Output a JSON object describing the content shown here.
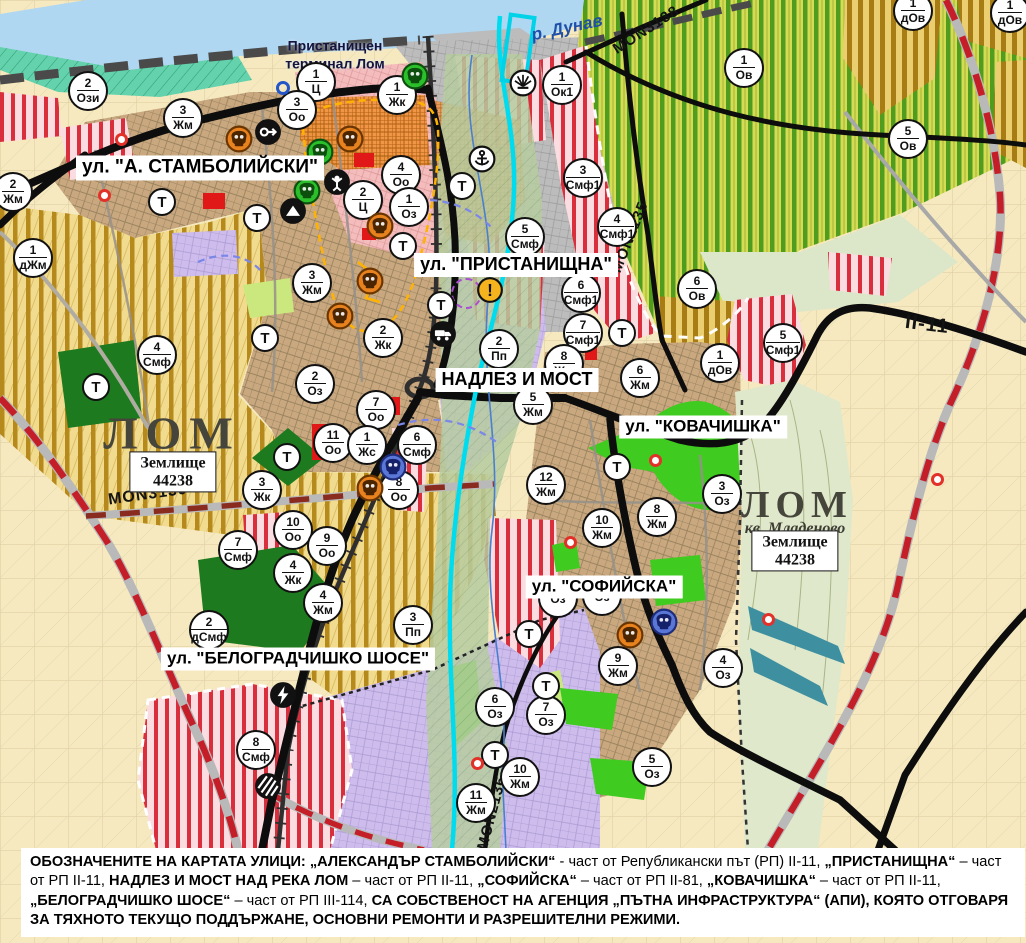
{
  "map": {
    "hydro_label": "р. Дунав",
    "port_label_line1": "Пристанищен",
    "port_label_line2": "терминал Лом",
    "t_label": "Т",
    "street_labels": [
      [
        "ул. \"А. СТАМБОЛИЙСКИ\"",
        200,
        168,
        19
      ],
      [
        "ул. \"ПРИСТАНИЩНА\"",
        516,
        265,
        18
      ],
      [
        "НАДЛЕЗ И МОСТ",
        517,
        380,
        18
      ],
      [
        "ул. \"КОВАЧИШКА\"",
        703,
        427,
        17
      ],
      [
        "ул. \"СОФИЙСКА\"",
        604,
        587,
        17
      ],
      [
        "ул. \"БЕЛОГРАДЧИШКО ШОСЕ\"",
        298,
        659,
        17
      ]
    ],
    "city_labels": [
      {
        "text": "ЛОМ",
        "x": 172,
        "y": 433,
        "cls": "city"
      },
      {
        "text": "ЛОМ",
        "x": 797,
        "y": 505,
        "cls": "city2"
      },
      {
        "text": "кв. Младеново",
        "x": 795,
        "y": 529,
        "cls": "sub"
      }
    ],
    "land_boxes": [
      {
        "line1": "Землище",
        "line2": "44238",
        "x": 173,
        "y": 472
      },
      {
        "line1": "Землище",
        "line2": "44238",
        "x": 795,
        "y": 551
      }
    ],
    "road_labels": [
      [
        "MON3139",
        148,
        495,
        -8,
        16
      ],
      [
        "MON2135",
        630,
        237,
        -68,
        15
      ],
      [
        "MON3138",
        646,
        30,
        -33,
        15
      ],
      [
        "MON2136",
        492,
        813,
        -75,
        15
      ],
      [
        "II-11",
        927,
        325,
        7,
        20
      ]
    ],
    "markers": [
      [
        88,
        91,
        "2",
        "Ози"
      ],
      [
        316,
        82,
        "1",
        "Ц"
      ],
      [
        297,
        110,
        "3",
        "Оо"
      ],
      [
        397,
        95,
        "1",
        "Жк"
      ],
      [
        562,
        85,
        "1",
        "Ок1"
      ],
      [
        183,
        118,
        "3",
        "Жм"
      ],
      [
        13,
        192,
        "2",
        "Жм"
      ],
      [
        33,
        258,
        "1",
        "дЖм"
      ],
      [
        157,
        355,
        "4",
        "Смф"
      ],
      [
        401,
        175,
        "4",
        "Оо"
      ],
      [
        363,
        200,
        "2",
        "Ц"
      ],
      [
        409,
        207,
        "1",
        "Оз"
      ],
      [
        312,
        283,
        "3",
        "Жм"
      ],
      [
        383,
        338,
        "2",
        "Жк"
      ],
      [
        315,
        384,
        "2",
        "Оз"
      ],
      [
        525,
        237,
        "5",
        "Смф"
      ],
      [
        583,
        178,
        "3",
        "Смф1"
      ],
      [
        617,
        227,
        "4",
        "Смф1"
      ],
      [
        744,
        68,
        "1",
        "Ов"
      ],
      [
        908,
        139,
        "5",
        "Ов"
      ],
      [
        913,
        11,
        "1",
        "дОв"
      ],
      [
        1010,
        13,
        "1",
        "дОв"
      ],
      [
        697,
        289,
        "6",
        "Ов"
      ],
      [
        720,
        363,
        "1",
        "дОв"
      ],
      [
        783,
        343,
        "5",
        "Смф1"
      ],
      [
        581,
        293,
        "6",
        "Смф1"
      ],
      [
        583,
        333,
        "7",
        "Смф1"
      ],
      [
        564,
        364,
        "8",
        "Жм"
      ],
      [
        499,
        349,
        "2",
        "Пп"
      ],
      [
        533,
        405,
        "5",
        "Жм"
      ],
      [
        640,
        378,
        "6",
        "Жм"
      ],
      [
        546,
        485,
        "12",
        "Жм"
      ],
      [
        376,
        410,
        "7",
        "Оо"
      ],
      [
        333,
        443,
        "11",
        "Оо"
      ],
      [
        367,
        445,
        "1",
        "Жс"
      ],
      [
        417,
        445,
        "6",
        "Смф"
      ],
      [
        399,
        490,
        "8",
        "Оо"
      ],
      [
        262,
        490,
        "3",
        "Жк"
      ],
      [
        293,
        530,
        "10",
        "Оо"
      ],
      [
        327,
        546,
        "9",
        "Оо"
      ],
      [
        238,
        550,
        "7",
        "Смф"
      ],
      [
        293,
        573,
        "4",
        "Жк"
      ],
      [
        323,
        603,
        "4",
        "Жм"
      ],
      [
        209,
        630,
        "2",
        "дСмф"
      ],
      [
        413,
        625,
        "3",
        "Пп"
      ],
      [
        256,
        750,
        "8",
        "Смф"
      ],
      [
        476,
        803,
        "11",
        "Жм"
      ],
      [
        520,
        777,
        "10",
        "Жм"
      ],
      [
        602,
        528,
        "10",
        "Жм"
      ],
      [
        657,
        517,
        "8",
        "Жм"
      ],
      [
        722,
        494,
        "3",
        "Оз"
      ],
      [
        618,
        666,
        "9",
        "Жм"
      ],
      [
        723,
        668,
        "4",
        "Оз"
      ],
      [
        495,
        707,
        "6",
        "Оз"
      ],
      [
        546,
        715,
        "7",
        "Оз"
      ],
      [
        652,
        767,
        "5",
        "Оз"
      ],
      [
        558,
        598,
        "",
        "Оз"
      ],
      [
        602,
        596,
        "",
        "Оз"
      ]
    ],
    "t_markers": [
      [
        162,
        202
      ],
      [
        257,
        218
      ],
      [
        403,
        246
      ],
      [
        265,
        338
      ],
      [
        96,
        387
      ],
      [
        287,
        457
      ],
      [
        441,
        305
      ],
      [
        462,
        186
      ],
      [
        622,
        333
      ],
      [
        617,
        467
      ],
      [
        529,
        634
      ],
      [
        546,
        686
      ],
      [
        495,
        755
      ]
    ],
    "icons": [
      [
        415,
        76,
        "monument",
        "green"
      ],
      [
        239,
        139,
        "monument",
        "orange"
      ],
      [
        268,
        132,
        "arrow",
        ""
      ],
      [
        350,
        139,
        "monument",
        "orange"
      ],
      [
        320,
        152,
        "monument",
        "green"
      ],
      [
        307,
        191,
        "monument",
        "green"
      ],
      [
        337,
        182,
        "person",
        ""
      ],
      [
        293,
        211,
        "mountain",
        ""
      ],
      [
        380,
        226,
        "monument",
        "orange"
      ],
      [
        370,
        281,
        "monument",
        "orange"
      ],
      [
        340,
        316,
        "monument",
        "orange"
      ],
      [
        523,
        83,
        "sun",
        ""
      ],
      [
        482,
        159,
        "anchor",
        ""
      ],
      [
        443,
        334,
        "truck",
        ""
      ],
      [
        490,
        290,
        "warning",
        ""
      ],
      [
        393,
        467,
        "monument",
        "blue"
      ],
      [
        370,
        488,
        "monument",
        "orange"
      ],
      [
        630,
        635,
        "monument",
        "orange"
      ],
      [
        664,
        622,
        "monument",
        "blue"
      ],
      [
        283,
        695,
        "lightning",
        ""
      ],
      [
        268,
        786,
        "crossing",
        ""
      ]
    ],
    "red_dots": [
      [
        121,
        139
      ],
      [
        104,
        195
      ],
      [
        655,
        460
      ],
      [
        570,
        542
      ],
      [
        768,
        619
      ],
      [
        477,
        763
      ],
      [
        937,
        479
      ]
    ],
    "blue_rings": [
      [
        283,
        88
      ]
    ],
    "dashed_circles": [
      [
        466,
        293
      ]
    ],
    "colors": {
      "water": "#AFD7F2",
      "vine_green": "#4F9C1F",
      "agri_yellow": "#B5891C",
      "urban_tan": "#C9A87F",
      "industrial_purple": "#CDBCEC",
      "mixed_red": "#D92F3C",
      "park_green": "#3FCB1F",
      "road_black": "#0D0D0D",
      "boundary_red": "#C41E28",
      "river_cyan": "#00DCEF"
    }
  },
  "caption": {
    "segments": [
      {
        "t": "ОБОЗНАЧЕНИТЕ НА КАРТАТА УЛИЦИ: „АЛЕКСАНДЪР СТАМБОЛИЙСКИ“",
        "b": 1
      },
      {
        "t": " - част от Републикански път (РП) II-11, ",
        "b": 0
      },
      {
        "t": "„ПРИСТАНИЩНА“",
        "b": 1
      },
      {
        "t": " – част от РП II-11, ",
        "b": 0
      },
      {
        "t": "НАДЛЕЗ И МОСТ НАД РЕКА ЛОМ",
        "b": 1
      },
      {
        "t": " – част от РП II-11, ",
        "b": 0
      },
      {
        "t": "„СОФИЙСКА“",
        "b": 1
      },
      {
        "t": " – част от РП II-81, ",
        "b": 0
      },
      {
        "t": "„КОВАЧИШКА“",
        "b": 1
      },
      {
        "t": " – част от РП II-11, ",
        "b": 0
      },
      {
        "t": "„БЕЛОГРАДЧИШКО ШОСЕ“",
        "b": 1
      },
      {
        "t": " – част от РП III-114, ",
        "b": 0
      },
      {
        "t": "СА СОБСТВЕНОСТ НА АГЕНЦИЯ „ПЪТНА ИНФРАСТРУКТУРА“ (АПИ), КОЯТО ОТГОВАРЯ ЗА ТЯХНОТО ТЕКУЩО ПОДДЪРЖАНЕ, ОСНОВНИ РЕМОНТИ И РАЗРЕШИТЕЛНИ РЕЖИМИ.",
        "b": 1
      }
    ]
  }
}
